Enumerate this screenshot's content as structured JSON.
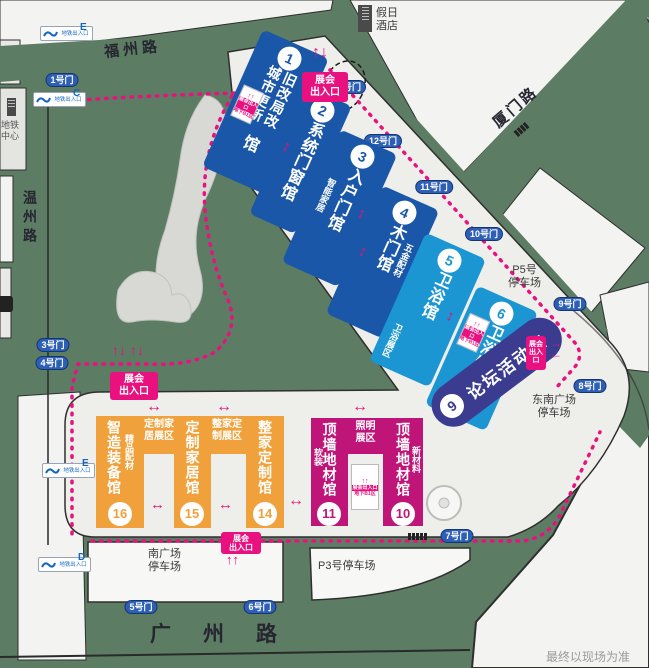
{
  "roads": {
    "north": "福州路",
    "northeast": "厦门路",
    "south": "广州路",
    "west": "温州路"
  },
  "labels": {
    "hotel_l1": "假日",
    "hotel_l2": "酒店",
    "metro_center_l1": "地铁",
    "metro_center_l2": "中心",
    "metro_exit": "地铁出入口",
    "disclaimer": "最终以现场为准"
  },
  "entrance": {
    "l1": "展会",
    "l2": "出入口"
  },
  "underground": {
    "band": "展会出入口",
    "note": "地下B1区"
  },
  "metro_exit_letters": [
    "E",
    "C",
    "E",
    "D"
  ],
  "gates": [
    "1号门",
    "3号门",
    "4号门",
    "5号门",
    "6号门",
    "7号门",
    "8号门",
    "9号门",
    "10号门",
    "11号门",
    "12号门",
    "13号门"
  ],
  "parking": {
    "p5_l1": "P5号",
    "p5_l2": "停车场",
    "se_l1": "东南广场",
    "se_l2": "停车场",
    "south_l1": "南广场",
    "south_l2": "停车场",
    "p3": "P3号停车场"
  },
  "zones": [
    {
      "l1": "定制家",
      "l2": "居展区"
    },
    {
      "l1": "整家定",
      "l2": "制展区"
    },
    {
      "l1": "照明",
      "l2": "展区"
    }
  ],
  "halls": {
    "h1": {
      "no": "1",
      "text": "旧改局改城市更新",
      "suffix": "馆",
      "name": "城市更新旧改局改馆"
    },
    "h2": {
      "no": "2",
      "text": "系统门窗馆"
    },
    "h3": {
      "no": "3",
      "text": "入户门馆",
      "side": "智能家居"
    },
    "h4": {
      "no": "4",
      "text": "木门馆",
      "side": "五金配材"
    },
    "h5": {
      "no": "5",
      "text": "卫浴馆",
      "side": "卫浴展区"
    },
    "h6": {
      "no": "6",
      "text": "卫浴馆",
      "side": "暖通厨电"
    },
    "h9": {
      "no": "9",
      "text": "论坛活动馆"
    },
    "h10": {
      "no": "10",
      "text": "顶墙地材馆",
      "side": "新材料"
    },
    "h11": {
      "no": "11",
      "text": "顶墙地材馆",
      "side": "软装"
    },
    "h14": {
      "no": "14",
      "text": "整家定制馆"
    },
    "h15": {
      "no": "15",
      "text": "定制家居馆"
    },
    "h16": {
      "no": "16",
      "text": "智造装备馆",
      "side": "精品配材"
    }
  },
  "colors": {
    "road_green": "#5d7c64",
    "dark_blue": "#1a57a8",
    "light_blue": "#1b96d3",
    "magenta": "#bf1478",
    "orange": "#f1a13b",
    "indigo": "#3b3c90",
    "pink": "#e8117f",
    "gate_blue": "#2e5fb7"
  }
}
